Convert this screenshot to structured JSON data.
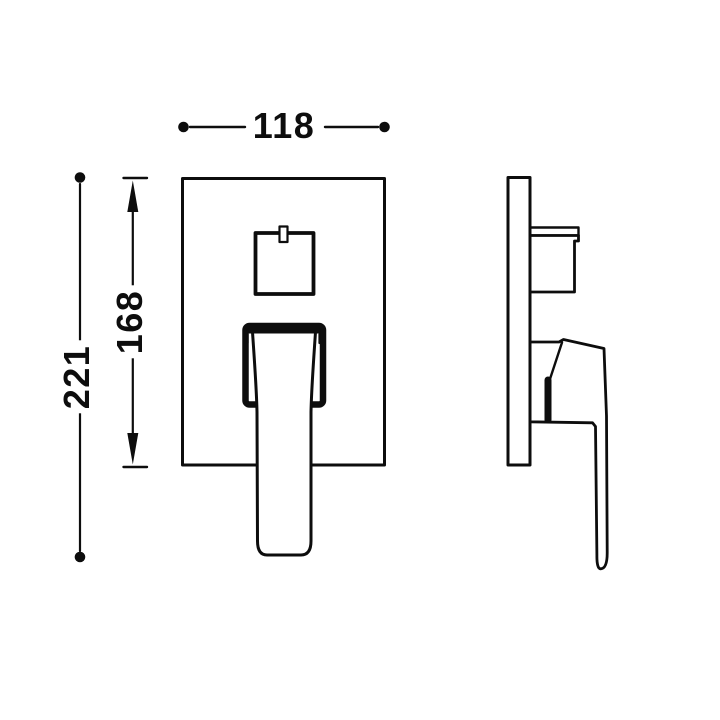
{
  "page": {
    "background_color": "#ffffff",
    "line_color": "#0d0d0d"
  },
  "drawing": {
    "kind": "technical-dimension-drawing",
    "views": [
      {
        "id": "front-view"
      },
      {
        "id": "side-view"
      }
    ],
    "dimensions": [
      {
        "label": "118",
        "orientation": "horizontal",
        "endpoints": "dots"
      },
      {
        "label": "221",
        "orientation": "vertical",
        "endpoints": "dots"
      },
      {
        "label": "168",
        "orientation": "vertical",
        "endpoints": "arrows-with-ticks"
      }
    ]
  }
}
